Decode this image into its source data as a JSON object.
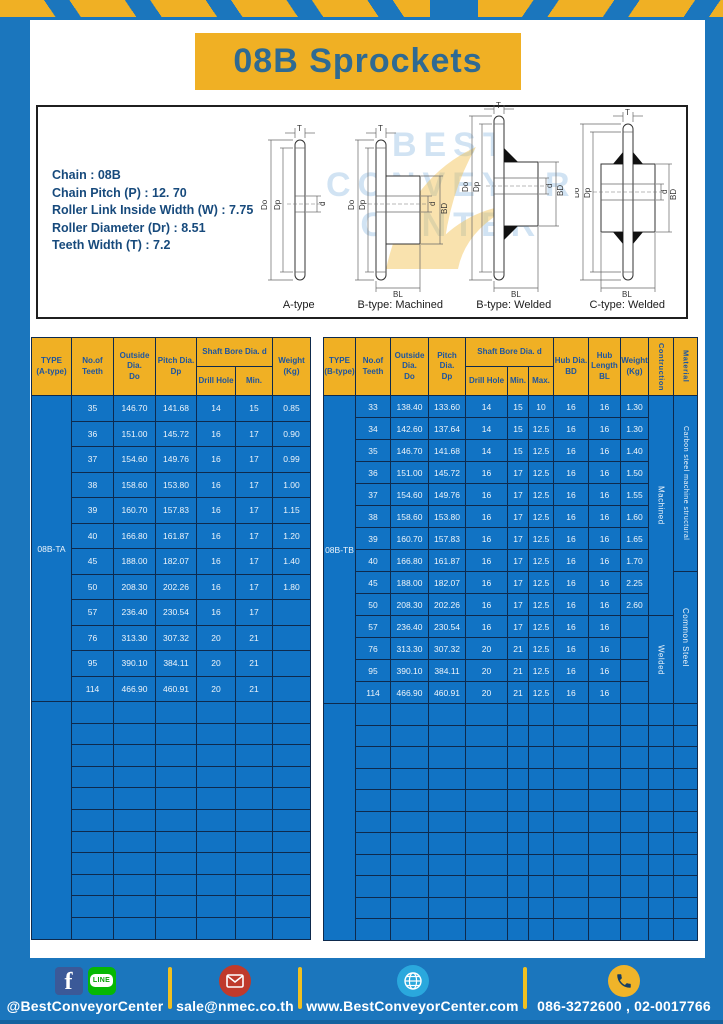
{
  "title": "08B Sprockets",
  "specs": [
    "Chain  : 08B",
    "Chain Pitch (P)  :  12. 70",
    "Roller Link Inside Width (W)  :  7.75",
    "Roller Diameter (Dr)  : 8.51",
    "Teeth Width (T)  :  7.2"
  ],
  "diagram": {
    "captions": [
      "A-type",
      "B-type: Machined",
      "B-type: Welded",
      "C-type: Welded"
    ],
    "dims": {
      "T": "T",
      "Do": "Do",
      "Dp": "Dp",
      "d": "d",
      "BD": "BD",
      "BL": "BL"
    },
    "watermark_lines": [
      "BEST",
      "CONVEYOR",
      "CENTER"
    ]
  },
  "tables": {
    "left": {
      "columns": [
        40,
        42,
        42,
        41,
        39,
        37,
        38
      ],
      "header_rows": 2,
      "header_row_h": 29,
      "data_row_h": 25.5,
      "empty_row_h": 21.6,
      "empty_rows": 11,
      "header_cells": [
        {
          "text": "TYPE\n(A-type)",
          "c": 1,
          "r": 1,
          "rs": 2
        },
        {
          "text": "No.of\nTeeth",
          "c": 2,
          "r": 1,
          "rs": 2
        },
        {
          "text": "Outside\nDia.\nDo",
          "c": 3,
          "r": 1,
          "rs": 2
        },
        {
          "text": "Pitch Dia.\nDp",
          "c": 4,
          "r": 1,
          "rs": 2
        },
        {
          "text": "Shaft Bore Dia. d",
          "c": 5,
          "r": 1,
          "cs": 2
        },
        {
          "text": "Drill Hole",
          "c": 5,
          "r": 2
        },
        {
          "text": "Min.",
          "c": 6,
          "r": 2
        },
        {
          "text": "Weight\n(Kg)",
          "c": 7,
          "r": 1,
          "rs": 2
        }
      ],
      "rows": [
        [
          "35",
          "146.70",
          "141.68",
          "14",
          "15",
          "0.85"
        ],
        [
          "36",
          "151.00",
          "145.72",
          "16",
          "17",
          "0.90"
        ],
        [
          "37",
          "154.60",
          "149.76",
          "16",
          "17",
          "0.99"
        ],
        [
          "38",
          "158.60",
          "153.80",
          "16",
          "17",
          "1.00"
        ],
        [
          "39",
          "160.70",
          "157.83",
          "16",
          "17",
          "1.15"
        ],
        [
          "40",
          "166.80",
          "161.87",
          "16",
          "17",
          "1.20"
        ],
        [
          "45",
          "188.00",
          "182.07",
          "16",
          "17",
          "1.40"
        ],
        [
          "50",
          "208.30",
          "202.26",
          "16",
          "17",
          "1.80"
        ],
        [
          "57",
          "236.40",
          "230.54",
          "16",
          "17",
          ""
        ],
        [
          "76",
          "313.30",
          "307.32",
          "20",
          "21",
          ""
        ],
        [
          "95",
          "390.10",
          "384.11",
          "20",
          "21",
          ""
        ],
        [
          "114",
          "466.90",
          "460.91",
          "20",
          "21",
          ""
        ]
      ],
      "merges": [
        {
          "c": 1,
          "r": 1,
          "span": 12,
          "text": "08B-TA",
          "cls": "dc"
        },
        {
          "c": 1,
          "r": 13,
          "span": 11,
          "text": "",
          "cls": "dc"
        }
      ]
    },
    "right": {
      "columns": [
        32,
        35,
        38,
        37,
        42,
        21,
        25,
        35,
        32,
        28,
        25,
        24
      ],
      "header_rows": 2,
      "header_row_h": 29,
      "data_row_h": 22,
      "empty_row_h": 21.5,
      "empty_rows": 11,
      "header_cells": [
        {
          "text": "TYPE\n(B-type)",
          "c": 1,
          "r": 1,
          "rs": 2
        },
        {
          "text": "No.of\nTeeth",
          "c": 2,
          "r": 1,
          "rs": 2
        },
        {
          "text": "Outside\nDia.\nDo",
          "c": 3,
          "r": 1,
          "rs": 2
        },
        {
          "text": "Pitch Dia.\nDp",
          "c": 4,
          "r": 1,
          "rs": 2
        },
        {
          "text": "Shaft Bore Dia. d",
          "c": 5,
          "r": 1,
          "cs": 3
        },
        {
          "text": "Drill Hole",
          "c": 5,
          "r": 2
        },
        {
          "text": "Min.",
          "c": 6,
          "r": 2
        },
        {
          "text": "Max.",
          "c": 7,
          "r": 2
        },
        {
          "text": "Hub Dia.\nBD",
          "c": 8,
          "r": 1,
          "rs": 2
        },
        {
          "text": "Hub\nLength\nBL",
          "c": 9,
          "r": 1,
          "rs": 2
        },
        {
          "text": "Weight\n(Kg)",
          "c": 10,
          "r": 1,
          "rs": 2
        },
        {
          "text": "Contruction",
          "c": 11,
          "r": 1,
          "rs": 2,
          "vert": true
        },
        {
          "text": "Material",
          "c": 12,
          "r": 1,
          "rs": 2,
          "vert": true
        }
      ],
      "rows": [
        [
          "33",
          "138.40",
          "133.60",
          "14",
          "15",
          "10",
          "16",
          "16",
          "1.30"
        ],
        [
          "34",
          "142.60",
          "137.64",
          "14",
          "15",
          "12.5",
          "16",
          "16",
          "1.30"
        ],
        [
          "35",
          "146.70",
          "141.68",
          "14",
          "15",
          "12.5",
          "16",
          "16",
          "1.40"
        ],
        [
          "36",
          "151.00",
          "145.72",
          "16",
          "17",
          "12.5",
          "16",
          "16",
          "1.50"
        ],
        [
          "37",
          "154.60",
          "149.76",
          "16",
          "17",
          "12.5",
          "16",
          "16",
          "1.55"
        ],
        [
          "38",
          "158.60",
          "153.80",
          "16",
          "17",
          "12.5",
          "16",
          "16",
          "1.60"
        ],
        [
          "39",
          "160.70",
          "157.83",
          "16",
          "17",
          "12.5",
          "16",
          "16",
          "1.65"
        ],
        [
          "40",
          "166.80",
          "161.87",
          "16",
          "17",
          "12.5",
          "16",
          "16",
          "1.70"
        ],
        [
          "45",
          "188.00",
          "182.07",
          "16",
          "17",
          "12.5",
          "16",
          "16",
          "2.25"
        ],
        [
          "50",
          "208.30",
          "202.26",
          "16",
          "17",
          "12.5",
          "16",
          "16",
          "2.60"
        ],
        [
          "57",
          "236.40",
          "230.54",
          "16",
          "17",
          "12.5",
          "16",
          "16",
          ""
        ],
        [
          "76",
          "313.30",
          "307.32",
          "20",
          "21",
          "12.5",
          "16",
          "16",
          ""
        ],
        [
          "95",
          "390.10",
          "384.11",
          "20",
          "21",
          "12.5",
          "16",
          "16",
          ""
        ],
        [
          "114",
          "466.90",
          "460.91",
          "20",
          "21",
          "12.5",
          "16",
          "16",
          ""
        ]
      ],
      "merges": [
        {
          "c": 1,
          "r": 1,
          "span": 14,
          "text": "08B-TB",
          "cls": "dc"
        },
        {
          "c": 1,
          "r": 15,
          "span": 11,
          "text": "",
          "cls": "dc"
        },
        {
          "c": 11,
          "r": 1,
          "span": 10,
          "text": "Machined",
          "cls": "dc vert"
        },
        {
          "c": 11,
          "r": 11,
          "span": 4,
          "text": "Welded",
          "cls": "dc vert"
        },
        {
          "c": 12,
          "r": 1,
          "span": 8,
          "text": "Carbon steel  machine structural",
          "cls": "dc vert sm"
        },
        {
          "c": 12,
          "r": 9,
          "span": 6,
          "text": "Common Steel",
          "cls": "dc vert"
        }
      ]
    }
  },
  "footer": {
    "handle": "@BestConveyorCenter",
    "email": "sale@nmec.co.th",
    "website": "www.BestConveyorCenter.com",
    "phone": "086-3272600 , 02-0017766",
    "facebook_glyph": "f",
    "line_glyph": "LINE"
  },
  "colors": {
    "frame_blue": "#1b76bd",
    "table_blue": "#1173c4",
    "accent_yellow": "#f0b024",
    "header_text_blue": "#1d55a0",
    "border_navy": "#0e2a4d"
  }
}
